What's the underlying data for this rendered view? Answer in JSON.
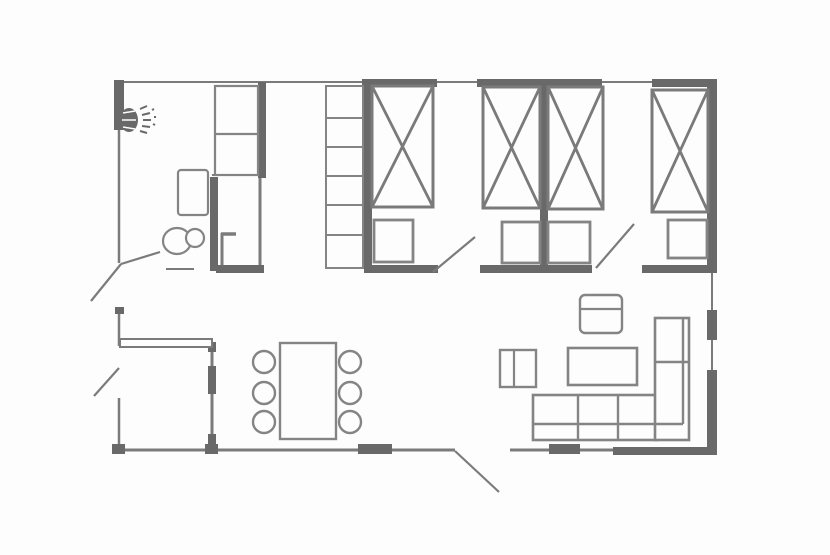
{
  "meta": {
    "description": "apartment-floor-plan",
    "canvas": {
      "width": 830,
      "height": 555
    }
  },
  "floorplan": {
    "colors": {
      "background": "#fdfdfd",
      "wall_dark": "#696969",
      "wall_mid": "#7b7b7b",
      "furniture": "#848484",
      "bed": "#7a7a7a"
    },
    "walls_thin": [
      {
        "name": "top-exterior-wall",
        "x1": 115,
        "y1": 82,
        "x2": 716,
        "y2": 82,
        "sw": 2
      },
      {
        "name": "left-wall-upper",
        "x1": 119,
        "y1": 82,
        "x2": 119,
        "y2": 263,
        "sw": 2.5
      },
      {
        "name": "left-wall-entry",
        "x1": 119,
        "y1": 310,
        "x2": 119,
        "y2": 346,
        "sw": 2.5
      },
      {
        "name": "left-wall-lower",
        "x1": 119,
        "y1": 398,
        "x2": 119,
        "y2": 451,
        "sw": 2.5
      },
      {
        "name": "bottom-wall-main",
        "x1": 114,
        "y1": 450,
        "x2": 455,
        "y2": 450,
        "sw": 3
      },
      {
        "name": "bottom-wall-living",
        "x1": 510,
        "y1": 450,
        "x2": 613,
        "y2": 450,
        "sw": 3
      },
      {
        "name": "right-wall-window-upper",
        "x1": 712,
        "y1": 273,
        "x2": 712,
        "y2": 310,
        "sw": 2
      },
      {
        "name": "right-wall-window-lower",
        "x1": 712,
        "y1": 340,
        "x2": 712,
        "y2": 370,
        "sw": 2
      },
      {
        "name": "entry-partition-wall",
        "x1": 212,
        "y1": 346,
        "x2": 212,
        "y2": 450,
        "sw": 3
      },
      {
        "name": "shower-cabin-right-wall",
        "x1": 260,
        "y1": 177,
        "x2": 260,
        "y2": 270,
        "sw": 3
      },
      {
        "name": "closet-bottom-line",
        "x1": 212,
        "y1": 175,
        "x2": 262,
        "y2": 175,
        "sw": 2
      },
      {
        "name": "shower-screen-vertical",
        "x1": 222,
        "y1": 233,
        "x2": 222,
        "y2": 270,
        "sw": 3
      },
      {
        "name": "shower-screen-top",
        "x1": 221,
        "y1": 234,
        "x2": 236,
        "y2": 234,
        "sw": 3.5
      },
      {
        "name": "bath-door-sill",
        "x1": 166,
        "y1": 269,
        "x2": 194,
        "y2": 269,
        "sw": 2
      }
    ],
    "walls_hollow": [
      {
        "name": "entry-hall-wall",
        "x": 120,
        "y": 339,
        "w": 92,
        "h": 8,
        "sw": 2
      }
    ],
    "walls_thick": [
      {
        "name": "top-wall-bedroom1",
        "x": 362,
        "y": 79,
        "w": 75,
        "h": 8
      },
      {
        "name": "top-wall-bedroom2",
        "x": 477,
        "y": 79,
        "w": 125,
        "h": 8
      },
      {
        "name": "top-wall-bedroom3",
        "x": 652,
        "y": 79,
        "w": 65,
        "h": 8
      },
      {
        "name": "left-wall-corner",
        "x": 114,
        "y": 80,
        "w": 10,
        "h": 50
      },
      {
        "name": "left-wall-entry-cap",
        "x": 115,
        "y": 307,
        "w": 9,
        "h": 7
      },
      {
        "name": "right-wall-upper",
        "x": 707,
        "y": 81,
        "w": 10,
        "h": 192
      },
      {
        "name": "right-wall-pier",
        "x": 707,
        "y": 310,
        "w": 10,
        "h": 30
      },
      {
        "name": "right-wall-lower",
        "x": 707,
        "y": 370,
        "w": 10,
        "h": 85
      },
      {
        "name": "bottom-wall-right",
        "x": 613,
        "y": 447,
        "w": 104,
        "h": 8
      },
      {
        "name": "bedroom1-left-wall",
        "x": 364,
        "y": 83,
        "w": 8,
        "h": 189
      },
      {
        "name": "bedroom-divider-wall",
        "x": 540,
        "y": 83,
        "w": 8,
        "h": 189
      },
      {
        "name": "bedroom1-bottom-wall",
        "x": 364,
        "y": 265,
        "w": 74,
        "h": 8
      },
      {
        "name": "bedroom2-bottom-wall",
        "x": 480,
        "y": 265,
        "w": 112,
        "h": 8
      },
      {
        "name": "bedroom3-bottom-wall",
        "x": 642,
        "y": 265,
        "w": 75,
        "h": 8
      },
      {
        "name": "bath-closet-wall",
        "x": 258,
        "y": 82,
        "w": 8,
        "h": 96
      },
      {
        "name": "shower-cabin-left-wall",
        "x": 210,
        "y": 177,
        "w": 8,
        "h": 94
      },
      {
        "name": "bath-bottom-wall",
        "x": 216,
        "y": 265,
        "w": 48,
        "h": 8
      },
      {
        "name": "bottom-window-dining",
        "x": 358,
        "y": 444,
        "w": 34,
        "h": 10
      },
      {
        "name": "bottom-window-living",
        "x": 549,
        "y": 444,
        "w": 31,
        "h": 10
      },
      {
        "name": "bottom-wall-nub-left",
        "x": 112,
        "y": 444,
        "w": 13,
        "h": 10
      },
      {
        "name": "bottom-wall-nub-mid",
        "x": 205,
        "y": 444,
        "w": 13,
        "h": 10
      },
      {
        "name": "entry-partition-thick",
        "x": 208,
        "y": 366,
        "w": 8,
        "h": 28
      },
      {
        "name": "entry-partition-nub-top",
        "x": 208,
        "y": 342,
        "w": 8,
        "h": 10
      },
      {
        "name": "entry-partition-nub-bottom",
        "x": 208,
        "y": 434,
        "w": 8,
        "h": 16
      }
    ],
    "beds": [
      {
        "name": "bed-1",
        "x": 372,
        "y": 86,
        "w": 61,
        "h": 121
      },
      {
        "name": "bed-2",
        "x": 483,
        "y": 87,
        "w": 57,
        "h": 121
      },
      {
        "name": "bed-3",
        "x": 548,
        "y": 87,
        "w": 55,
        "h": 122
      },
      {
        "name": "bed-4",
        "x": 652,
        "y": 90,
        "w": 56,
        "h": 122
      }
    ],
    "furniture_rects": [
      {
        "name": "bath-closet",
        "x": 215,
        "y": 86,
        "w": 43,
        "h": 89,
        "sw": 2.2
      },
      {
        "name": "bath-sink",
        "x": 178,
        "y": 170,
        "w": 30,
        "h": 45,
        "sw": 2.2,
        "rx": 3
      },
      {
        "name": "hall-wardrobe",
        "x": 326,
        "y": 86,
        "w": 37,
        "h": 182,
        "sw": 2
      },
      {
        "name": "nightstand-1",
        "x": 374,
        "y": 220,
        "w": 39,
        "h": 42,
        "sw": 2.8
      },
      {
        "name": "nightstand-2",
        "x": 502,
        "y": 222,
        "w": 38,
        "h": 41,
        "sw": 2.8
      },
      {
        "name": "nightstand-3",
        "x": 548,
        "y": 222,
        "w": 42,
        "h": 41,
        "sw": 2.8
      },
      {
        "name": "nightstand-4",
        "x": 668,
        "y": 220,
        "w": 39,
        "h": 38,
        "sw": 2.8
      },
      {
        "name": "dining-table",
        "x": 280,
        "y": 343,
        "w": 56,
        "h": 96,
        "sw": 2.4
      },
      {
        "name": "armchair",
        "x": 580,
        "y": 295,
        "w": 42,
        "h": 38,
        "sw": 2.4,
        "rx": 5
      },
      {
        "name": "side-table",
        "x": 500,
        "y": 350,
        "w": 36,
        "h": 37,
        "sw": 2.4
      },
      {
        "name": "coffee-table",
        "x": 568,
        "y": 348,
        "w": 69,
        "h": 37,
        "sw": 2.6
      },
      {
        "name": "sofa-main",
        "x": 533,
        "y": 395,
        "w": 124,
        "h": 45,
        "sw": 2.6
      },
      {
        "name": "sofa-chaise",
        "x": 655,
        "y": 318,
        "w": 34,
        "h": 122,
        "sw": 2.6
      }
    ],
    "furniture_lines": [
      {
        "name": "closet-shelf-divider",
        "x1": 215,
        "y1": 134,
        "x2": 258,
        "y2": 134,
        "sw": 2.2
      },
      {
        "name": "wardrobe-shelf-1",
        "x1": 326,
        "y1": 118,
        "x2": 363,
        "y2": 118,
        "sw": 2
      },
      {
        "name": "wardrobe-shelf-2",
        "x1": 326,
        "y1": 147,
        "x2": 363,
        "y2": 147,
        "sw": 2
      },
      {
        "name": "wardrobe-shelf-3",
        "x1": 326,
        "y1": 176,
        "x2": 363,
        "y2": 176,
        "sw": 2
      },
      {
        "name": "wardrobe-shelf-4",
        "x1": 326,
        "y1": 205,
        "x2": 363,
        "y2": 205,
        "sw": 2
      },
      {
        "name": "wardrobe-shelf-5",
        "x1": 326,
        "y1": 235,
        "x2": 363,
        "y2": 235,
        "sw": 2
      },
      {
        "name": "armchair-back-line",
        "x1": 580,
        "y1": 309,
        "x2": 622,
        "y2": 309,
        "sw": 2.2
      },
      {
        "name": "side-table-divider",
        "x1": 514,
        "y1": 350,
        "x2": 514,
        "y2": 387,
        "sw": 2.2
      },
      {
        "name": "sofa-seat-divider-1",
        "x1": 578,
        "y1": 395,
        "x2": 578,
        "y2": 440,
        "sw": 2.4
      },
      {
        "name": "sofa-seat-divider-2",
        "x1": 618,
        "y1": 395,
        "x2": 618,
        "y2": 440,
        "sw": 2.4
      },
      {
        "name": "sofa-backrest-line",
        "x1": 533,
        "y1": 424,
        "x2": 683,
        "y2": 424,
        "sw": 2.4
      },
      {
        "name": "sofa-chaise-divider",
        "x1": 655,
        "y1": 362,
        "x2": 689,
        "y2": 362,
        "sw": 2.4
      },
      {
        "name": "sofa-chaise-backrest",
        "x1": 683,
        "y1": 318,
        "x2": 683,
        "y2": 424,
        "sw": 2.4
      }
    ],
    "circles": [
      {
        "name": "dining-chair-1",
        "cx": 264,
        "cy": 362,
        "r": 11,
        "sw": 2.4
      },
      {
        "name": "dining-chair-2",
        "cx": 264,
        "cy": 393,
        "r": 11,
        "sw": 2.4
      },
      {
        "name": "dining-chair-3",
        "cx": 264,
        "cy": 422,
        "r": 11,
        "sw": 2.4
      },
      {
        "name": "dining-chair-4",
        "cx": 350,
        "cy": 362,
        "r": 11,
        "sw": 2.4
      },
      {
        "name": "dining-chair-5",
        "cx": 350,
        "cy": 393,
        "r": 11,
        "sw": 2.4
      },
      {
        "name": "dining-chair-6",
        "cx": 350,
        "cy": 422,
        "r": 11,
        "sw": 2.4
      }
    ],
    "ellipses": [
      {
        "name": "toilet-bowl",
        "cx": 177,
        "cy": 241,
        "rx": 14,
        "ry": 13,
        "sw": 2.2
      },
      {
        "name": "toilet-tank",
        "cx": 195,
        "cy": 238,
        "rx": 9,
        "ry": 9,
        "sw": 2.2
      }
    ],
    "doors": [
      {
        "name": "bath-door-leaf-a",
        "x1": 160,
        "y1": 252,
        "x2": 121,
        "y2": 264
      },
      {
        "name": "bath-door-leaf-b",
        "x1": 121,
        "y1": 264,
        "x2": 91,
        "y2": 301
      },
      {
        "name": "side-door-leaf",
        "x1": 119,
        "y1": 368,
        "x2": 94,
        "y2": 396
      },
      {
        "name": "bedroom1-door-leaf",
        "x1": 433,
        "y1": 272,
        "x2": 475,
        "y2": 237
      },
      {
        "name": "bedroom2-door-leaf",
        "x1": 596,
        "y1": 268,
        "x2": 634,
        "y2": 224
      },
      {
        "name": "entry-door-leaf",
        "x1": 455,
        "y1": 451,
        "x2": 499,
        "y2": 492
      }
    ],
    "shower": {
      "head": {
        "cx": 129,
        "cy": 120,
        "rx": 9,
        "ry": 12
      },
      "head_lines": [
        {
          "x1": 123,
          "y1": 113,
          "x2": 135,
          "y2": 111
        },
        {
          "x1": 122,
          "y1": 120,
          "x2": 136,
          "y2": 120
        },
        {
          "x1": 123,
          "y1": 127,
          "x2": 135,
          "y2": 129
        }
      ],
      "spray": [
        {
          "x1": 140,
          "y1": 109,
          "x2": 147,
          "y2": 106
        },
        {
          "x1": 142,
          "y1": 115,
          "x2": 150,
          "y2": 113
        },
        {
          "x1": 143,
          "y1": 120,
          "x2": 151,
          "y2": 120
        },
        {
          "x1": 142,
          "y1": 126,
          "x2": 150,
          "y2": 127
        },
        {
          "x1": 140,
          "y1": 131,
          "x2": 147,
          "y2": 133
        },
        {
          "x1": 152,
          "y1": 110,
          "x2": 154,
          "y2": 109
        },
        {
          "x1": 154,
          "y1": 117,
          "x2": 156,
          "y2": 117
        },
        {
          "x1": 153,
          "y1": 124,
          "x2": 155,
          "y2": 125
        }
      ]
    }
  }
}
